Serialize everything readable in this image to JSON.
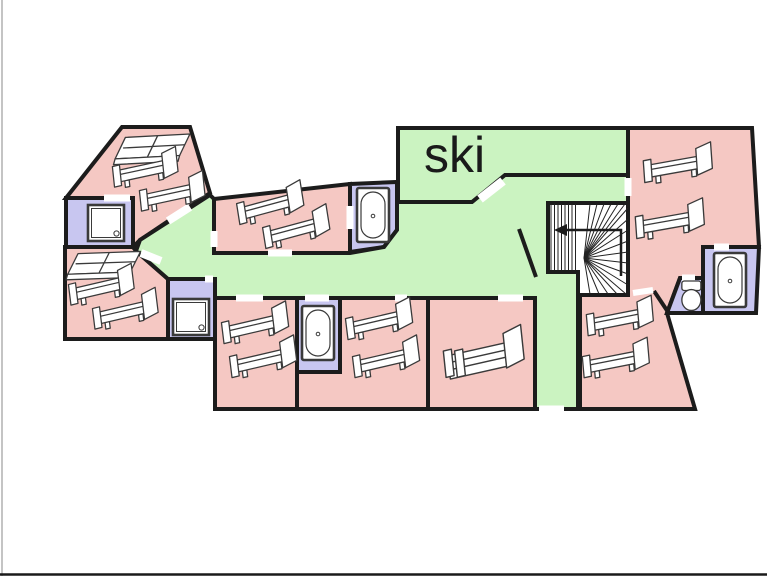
{
  "canvas": {
    "width": 767,
    "height": 576
  },
  "labels": {
    "ski_room": "ski"
  },
  "palette": {
    "bedroom": "#f5c8c3",
    "corridor": "#cbf3c1",
    "bathroom": "#c8c6f0",
    "stair": "#ffffff",
    "wall": "#1c1c1c",
    "door_gap": "#ffffff",
    "furniture_stroke": "#3a3a3a",
    "furniture_fill": "#ffffff",
    "label_color": "#1a1a1a",
    "edge_left": "#b0b0b0",
    "edge_bottom": "#1a1a1a"
  },
  "rooms": [
    {
      "id": "bedroom-northwest",
      "type": "bedroom",
      "points": [
        [
          66,
          198
        ],
        [
          122,
          127
        ],
        [
          190,
          127
        ],
        [
          210,
          193
        ],
        [
          140,
          240
        ],
        [
          133,
          247
        ],
        [
          133,
          198
        ]
      ]
    },
    {
      "id": "shower-room-northwest",
      "type": "bathroom",
      "points": [
        [
          66,
          198
        ],
        [
          133,
          198
        ],
        [
          133,
          247
        ],
        [
          66,
          247
        ]
      ]
    },
    {
      "id": "bedroom-west",
      "type": "bedroom",
      "points": [
        [
          65,
          247
        ],
        [
          133,
          247
        ],
        [
          136,
          251
        ],
        [
          168,
          279
        ],
        [
          168,
          339
        ],
        [
          65,
          339
        ]
      ]
    },
    {
      "id": "shower-room-west",
      "type": "bathroom",
      "points": [
        [
          168,
          279
        ],
        [
          215,
          279
        ],
        [
          215,
          339
        ],
        [
          168,
          339
        ]
      ]
    },
    {
      "id": "bedroom-north-middle",
      "type": "bedroom",
      "points": [
        [
          214,
          199
        ],
        [
          350,
          184
        ],
        [
          350,
          253
        ],
        [
          214,
          253
        ]
      ]
    },
    {
      "id": "bathroom-north-middle",
      "type": "bathroom",
      "points": [
        [
          350,
          184
        ],
        [
          397,
          182
        ],
        [
          397,
          230
        ],
        [
          384,
          247
        ],
        [
          350,
          252
        ]
      ]
    },
    {
      "id": "ski-room",
      "type": "corridor",
      "points": [
        [
          398,
          128
        ],
        [
          628,
          128
        ],
        [
          628,
          175
        ],
        [
          510,
          175
        ],
        [
          475,
          202
        ],
        [
          398,
          202
        ]
      ]
    },
    {
      "id": "corridor",
      "type": "corridor",
      "points": [
        [
          210,
          195
        ],
        [
          214,
          199
        ],
        [
          214,
          253
        ],
        [
          350,
          253
        ],
        [
          384,
          247
        ],
        [
          397,
          230
        ],
        [
          397,
          202
        ],
        [
          472,
          202
        ],
        [
          505,
          175
        ],
        [
          628,
          175
        ],
        [
          628,
          203
        ],
        [
          548,
          203
        ],
        [
          548,
          272
        ],
        [
          578,
          272
        ],
        [
          578,
          295
        ],
        [
          578,
          409
        ],
        [
          535,
          409
        ],
        [
          535,
          298
        ],
        [
          215,
          298
        ],
        [
          215,
          279
        ],
        [
          168,
          279
        ],
        [
          136,
          251
        ],
        [
          140,
          240
        ]
      ]
    },
    {
      "id": "bedroom-south-1",
      "type": "bedroom",
      "points": [
        [
          215,
          298
        ],
        [
          297,
          298
        ],
        [
          297,
          409
        ],
        [
          215,
          409
        ]
      ]
    },
    {
      "id": "bathroom-south",
      "type": "bathroom",
      "points": [
        [
          297,
          298
        ],
        [
          340,
          298
        ],
        [
          340,
          372
        ],
        [
          297,
          372
        ]
      ]
    },
    {
      "id": "bedroom-south-2",
      "type": "bedroom",
      "points": [
        [
          340,
          298
        ],
        [
          428,
          298
        ],
        [
          428,
          409
        ],
        [
          297,
          409
        ],
        [
          297,
          372
        ],
        [
          340,
          372
        ]
      ]
    },
    {
      "id": "bedroom-south-3",
      "type": "bedroom",
      "points": [
        [
          428,
          298
        ],
        [
          535,
          298
        ],
        [
          535,
          409
        ],
        [
          428,
          409
        ]
      ]
    },
    {
      "id": "bedroom-east",
      "type": "bedroom",
      "points": [
        [
          628,
          128
        ],
        [
          752,
          128
        ],
        [
          759,
          247
        ],
        [
          703,
          247
        ],
        [
          703,
          278
        ],
        [
          680,
          278
        ],
        [
          667,
          313
        ],
        [
          695,
          409
        ],
        [
          580,
          409
        ],
        [
          580,
          295
        ],
        [
          628,
          295
        ]
      ]
    },
    {
      "id": "bathroom-east",
      "type": "bathroom",
      "points": [
        [
          703,
          247
        ],
        [
          759,
          247
        ],
        [
          756,
          313
        ],
        [
          703,
          313
        ]
      ]
    },
    {
      "id": "wc-east",
      "type": "bathroom",
      "points": [
        [
          680,
          278
        ],
        [
          703,
          278
        ],
        [
          703,
          313
        ],
        [
          667,
          313
        ]
      ]
    },
    {
      "id": "staircase-enclosure",
      "type": "stair",
      "points": [
        [
          548,
          203
        ],
        [
          628,
          203
        ],
        [
          628,
          295
        ],
        [
          578,
          295
        ],
        [
          578,
          272
        ],
        [
          548,
          272
        ]
      ]
    }
  ],
  "interior_walls": [
    {
      "id": "corridor-diagonal-wall",
      "x1": 519,
      "y1": 229,
      "x2": 536,
      "y2": 277
    },
    {
      "id": "wc-west-wall-stub",
      "x1": 654,
      "y1": 291,
      "x2": 668,
      "y2": 312
    }
  ],
  "door_gaps": [
    {
      "id": "door-nw-bedroom-shower",
      "x1": 104,
      "y1": 198,
      "x2": 130,
      "y2": 198,
      "w": 7
    },
    {
      "id": "door-nw-bedroom-corridor",
      "x1": 168,
      "y1": 221,
      "x2": 190,
      "y2": 207,
      "w": 8
    },
    {
      "id": "door-west-bedroom-corridor",
      "x1": 141,
      "y1": 253,
      "x2": 161,
      "y2": 261,
      "w": 8
    },
    {
      "id": "door-west-shower-corridor",
      "x1": 205,
      "y1": 279,
      "x2": 213,
      "y2": 279,
      "w": 7
    },
    {
      "id": "door-middle-bedroom-west",
      "x1": 214,
      "y1": 231,
      "x2": 214,
      "y2": 247,
      "w": 7
    },
    {
      "id": "door-middle-bedroom-south",
      "x1": 268,
      "y1": 253,
      "x2": 292,
      "y2": 253,
      "w": 7
    },
    {
      "id": "door-middle-bathroom",
      "x1": 350,
      "y1": 206,
      "x2": 350,
      "y2": 229,
      "w": 7
    },
    {
      "id": "door-ski-room",
      "x1": 480,
      "y1": 199,
      "x2": 503,
      "y2": 181,
      "w": 9
    },
    {
      "id": "door-east-bedroom-corridor",
      "x1": 628,
      "y1": 178,
      "x2": 628,
      "y2": 196,
      "w": 7
    },
    {
      "id": "door-south-1",
      "x1": 236,
      "y1": 298,
      "x2": 263,
      "y2": 298,
      "w": 7
    },
    {
      "id": "door-south-bathroom",
      "x1": 305,
      "y1": 298,
      "x2": 329,
      "y2": 298,
      "w": 7
    },
    {
      "id": "door-south-2",
      "x1": 395,
      "y1": 298,
      "x2": 407,
      "y2": 298,
      "w": 7
    },
    {
      "id": "door-south-3",
      "x1": 498,
      "y1": 298,
      "x2": 523,
      "y2": 298,
      "w": 7
    },
    {
      "id": "door-corridor-exit",
      "x1": 539,
      "y1": 409,
      "x2": 564,
      "y2": 409,
      "w": 7
    },
    {
      "id": "door-east-bedroom-south",
      "x1": 633,
      "y1": 293,
      "x2": 653,
      "y2": 290,
      "w": 6
    },
    {
      "id": "door-east-bathroom",
      "x1": 714,
      "y1": 247,
      "x2": 729,
      "y2": 247,
      "w": 7
    },
    {
      "id": "door-wc",
      "x1": 682,
      "y1": 278,
      "x2": 695,
      "y2": 278,
      "w": 7
    }
  ],
  "staircase": {
    "treads_x": [
      551,
      554.5,
      558,
      561.5,
      565,
      568.5,
      572,
      575.5
    ],
    "treads_y1": 204,
    "treads_y2": 270,
    "fan_center": [
      584,
      258
    ],
    "fan_ends": [
      [
        590,
        204
      ],
      [
        597,
        204
      ],
      [
        604,
        204
      ],
      [
        611,
        204
      ],
      [
        618,
        204
      ],
      [
        625,
        204
      ],
      [
        628,
        208
      ],
      [
        628,
        219
      ],
      [
        628,
        230
      ],
      [
        628,
        241
      ],
      [
        628,
        252
      ],
      [
        628,
        263
      ],
      [
        628,
        274
      ],
      [
        628,
        285
      ],
      [
        626,
        294
      ],
      [
        617,
        294
      ],
      [
        608,
        294
      ],
      [
        599,
        294
      ],
      [
        590,
        294
      ]
    ],
    "arrow_shaft": [
      [
        621,
        276
      ],
      [
        621,
        230
      ],
      [
        567,
        230
      ]
    ],
    "arrow_head": [
      [
        567,
        224
      ],
      [
        567,
        236
      ],
      [
        554,
        230
      ]
    ]
  },
  "furniture": [
    {
      "name": "double-bed",
      "room": "bedroom-northwest",
      "g": "dbed",
      "x": 114,
      "y": 138,
      "r": -3,
      "s": 0.95
    },
    {
      "name": "single-bed",
      "room": "bedroom-northwest",
      "g": "bed",
      "x": 112,
      "y": 163,
      "r": -6,
      "s": 0.9
    },
    {
      "name": "single-bed",
      "room": "bedroom-northwest",
      "g": "bed",
      "x": 139,
      "y": 187,
      "r": -6,
      "s": 0.9
    },
    {
      "name": "shower",
      "room": "shower-room-northwest",
      "g": "shower",
      "x": 88,
      "y": 205,
      "r": 0,
      "s": 1
    },
    {
      "name": "double-bed",
      "room": "bedroom-west",
      "g": "dbed",
      "x": 67,
      "y": 254,
      "r": -2,
      "s": 0.92
    },
    {
      "name": "single-bed",
      "room": "bedroom-west",
      "g": "bed",
      "x": 68,
      "y": 281,
      "r": -7,
      "s": 0.9
    },
    {
      "name": "single-bed",
      "room": "bedroom-west",
      "g": "bed",
      "x": 92,
      "y": 305,
      "r": -7,
      "s": 0.9
    },
    {
      "name": "shower",
      "room": "shower-room-west",
      "g": "shower",
      "x": 173,
      "y": 299,
      "r": 0,
      "s": 1
    },
    {
      "name": "single-bed",
      "room": "bedroom-north-middle",
      "g": "bed",
      "x": 236,
      "y": 200,
      "r": -9,
      "s": 0.92
    },
    {
      "name": "single-bed",
      "room": "bedroom-north-middle",
      "g": "bed",
      "x": 262,
      "y": 224,
      "r": -9,
      "s": 0.92
    },
    {
      "name": "bathtub",
      "room": "bathroom-north-middle",
      "g": "tub",
      "x": 357,
      "y": 188,
      "r": 0,
      "s": 1
    },
    {
      "name": "single-bed",
      "room": "bedroom-south-1",
      "g": "bed",
      "x": 221,
      "y": 319,
      "r": -7,
      "s": 0.92
    },
    {
      "name": "single-bed",
      "room": "bedroom-south-1",
      "g": "bed",
      "x": 229,
      "y": 353,
      "r": -7,
      "s": 0.92
    },
    {
      "name": "bathtub",
      "room": "bathroom-south",
      "g": "tub",
      "x": 302,
      "y": 306,
      "r": 0,
      "s": 1
    },
    {
      "name": "single-bed",
      "room": "bedroom-south-2",
      "g": "bed",
      "x": 345,
      "y": 315,
      "r": -7,
      "s": 0.92
    },
    {
      "name": "single-bed",
      "room": "bedroom-south-2",
      "g": "bed",
      "x": 352,
      "y": 353,
      "r": -7,
      "s": 0.92
    },
    {
      "name": "double-bed",
      "room": "bedroom-south-3",
      "g": "bedq",
      "x": 443,
      "y": 348,
      "r": -6,
      "s": 1.02
    },
    {
      "name": "single-bed",
      "room": "bedroom-east",
      "g": "bed",
      "x": 586,
      "y": 311,
      "r": -5,
      "s": 0.92
    },
    {
      "name": "single-bed",
      "room": "bedroom-east",
      "g": "bed",
      "x": 582,
      "y": 353,
      "r": -5,
      "s": 0.92
    },
    {
      "name": "single-bed",
      "room": "bedroom-east",
      "g": "bed",
      "x": 643,
      "y": 157,
      "r": -4,
      "s": 0.95
    },
    {
      "name": "single-bed",
      "room": "bedroom-east",
      "g": "bed",
      "x": 635,
      "y": 213,
      "r": -4,
      "s": 0.95
    },
    {
      "name": "bathtub",
      "room": "bathroom-east",
      "g": "tub",
      "x": 714,
      "y": 253,
      "r": 0,
      "s": 1
    },
    {
      "name": "toilet",
      "room": "wc-east",
      "g": "toilet",
      "x": 679,
      "y": 281,
      "r": 0,
      "s": 0.95
    }
  ],
  "ski_label": {
    "x": 424,
    "y": 172,
    "font_size": 50
  }
}
